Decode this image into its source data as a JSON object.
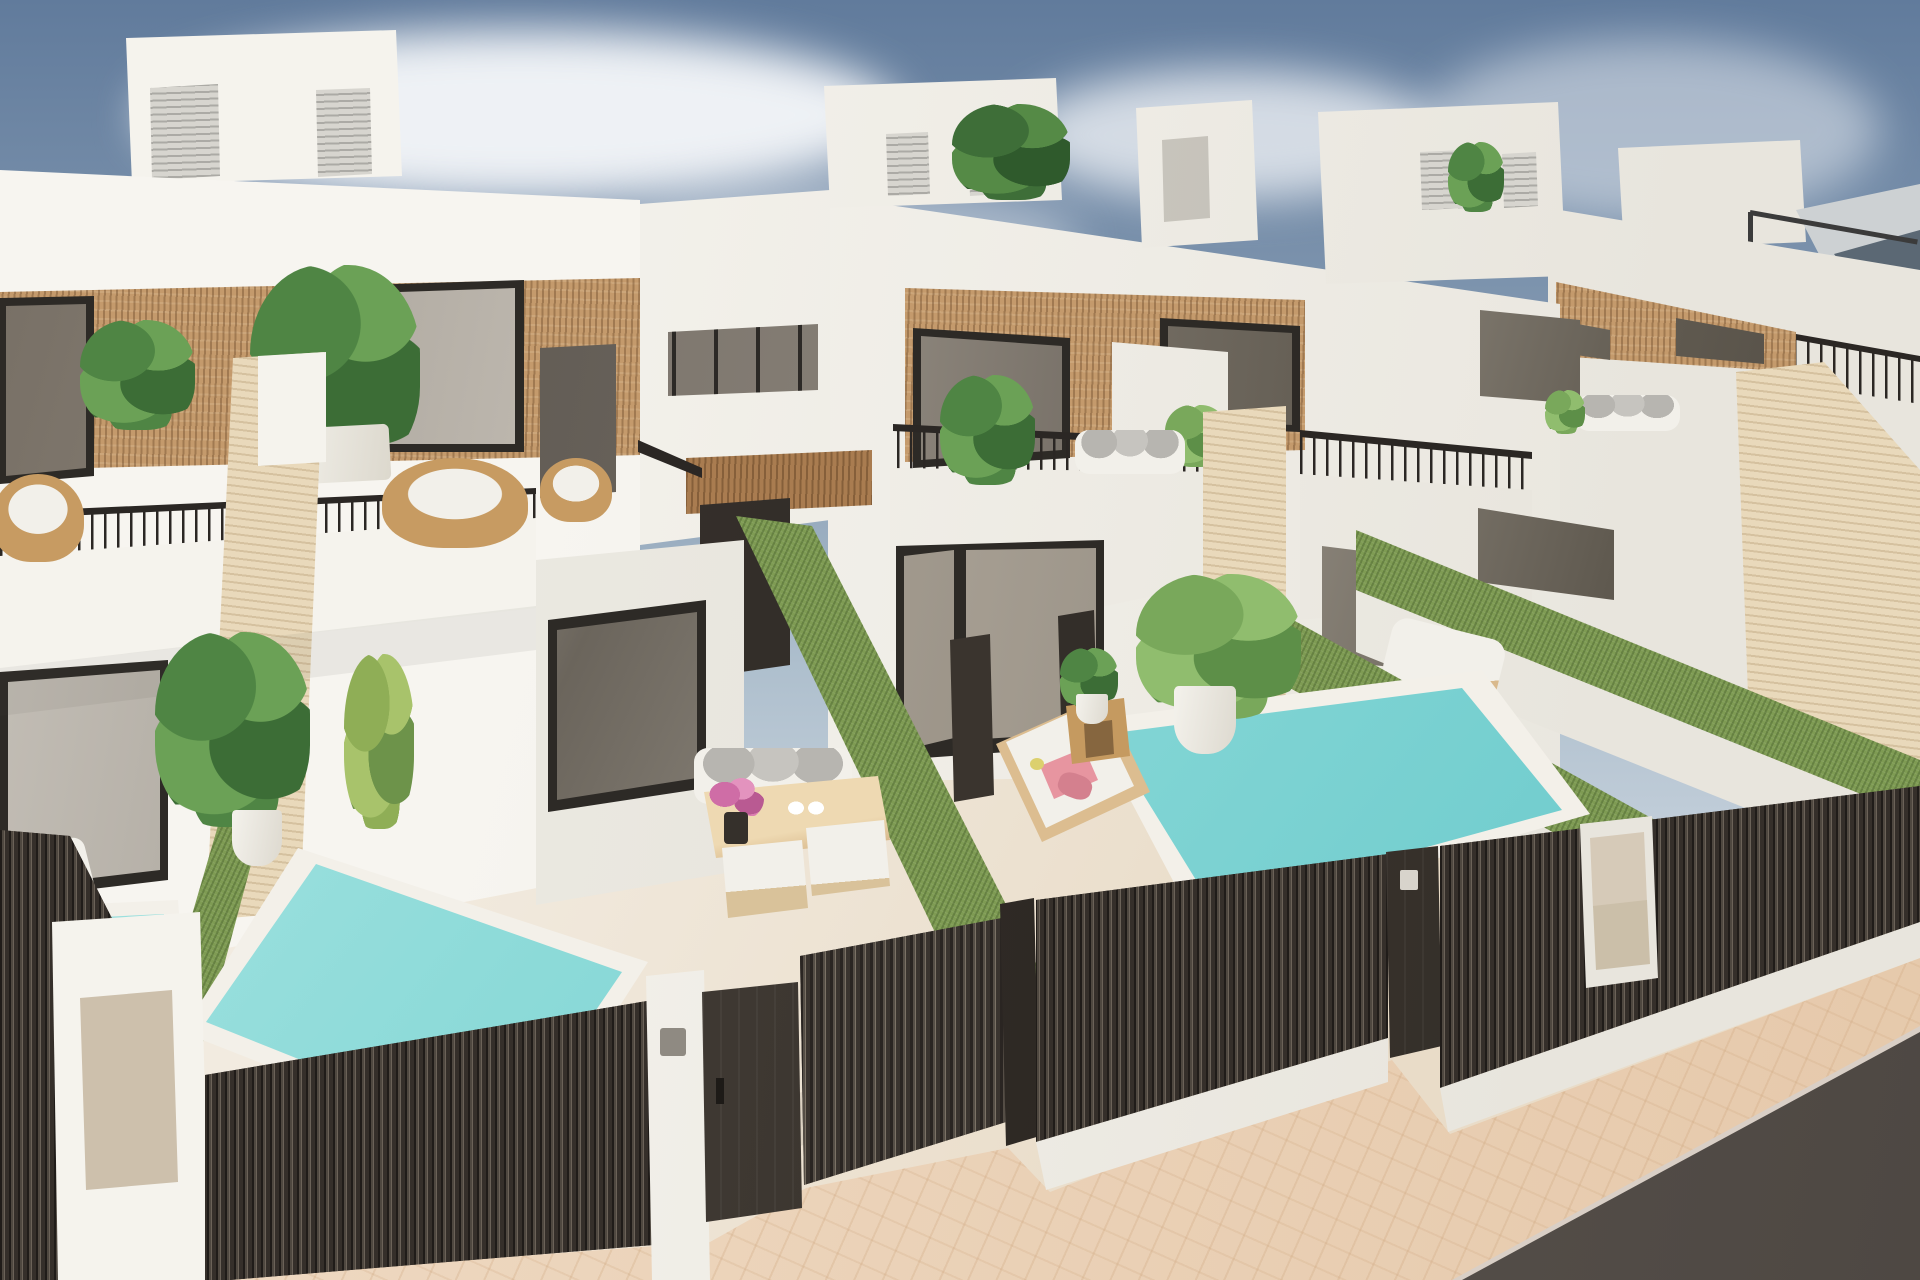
{
  "scene": {
    "image_type": "3d-architectural-render",
    "description": "Aerial three-quarter view of a row of modern white two-storey villas with rooftop stair boxes, wood-slat facade accents, black-framed glazing, railed terraces, private patios with turquoise plunge pools, green-topped dividing walls, travertine pillars and dark slatted street gates beside a paved sidewalk and asphalt road.",
    "text_present": false
  },
  "colors": {
    "sky_top": "#617b9c",
    "sky_mid": "#8ba0b6",
    "sky_low": "#c6d1dc",
    "cloud": "#eef1f5",
    "wall": "#f5f3ed",
    "wall_shade": "#e8e5dd",
    "wood": "#c49a6c",
    "wood_dark": "#a97c50",
    "frame": "#2d2a26",
    "glass_hi": "#948c81",
    "travertine": "#e9d9bb",
    "grass": "#7e9b53",
    "pool_hi": "#b7e9e7",
    "pool_lo": "#5fc4c7",
    "fence": "#352f2a",
    "fence_hi": "#6b6258",
    "rail": "#2b2724",
    "floor_hi": "#f2ebe0",
    "floor_lo": "#e9dcc8",
    "pave_hi": "#f0dcc6",
    "pave_lo": "#e6c9ab",
    "road": "#4e4843",
    "rattan": "#c79b62",
    "cushion": "#f2f0ea",
    "pillow": "#b7b5b0",
    "pink": "#e795a0",
    "magenta": "#cf6da6",
    "leaf": "#4f8544",
    "leaf_light": "#79a85b",
    "fern": "#8fae56",
    "panel": "#d6cab8",
    "parasol": "#cdd1d3"
  },
  "objects": {
    "houses": [
      "villa-left",
      "villa-middle",
      "villa-right",
      "villa-far-right"
    ],
    "features": [
      "rooftop-stair-boxes",
      "roller-shutter-doors",
      "wood-slat-cladding",
      "terrace-railings",
      "rattan-chairs",
      "balcony-plants",
      "travertine-pillars",
      "green-topped-garden-walls",
      "plunge-pools",
      "sun-loungers",
      "pink-towels",
      "outdoor-dining-set",
      "potted-plants",
      "dark-slatted-fences",
      "sliding-gates",
      "keypads",
      "utility-meter-boxes",
      "paved-sidewalk",
      "asphalt-road",
      "cantilever-parasol"
    ]
  }
}
